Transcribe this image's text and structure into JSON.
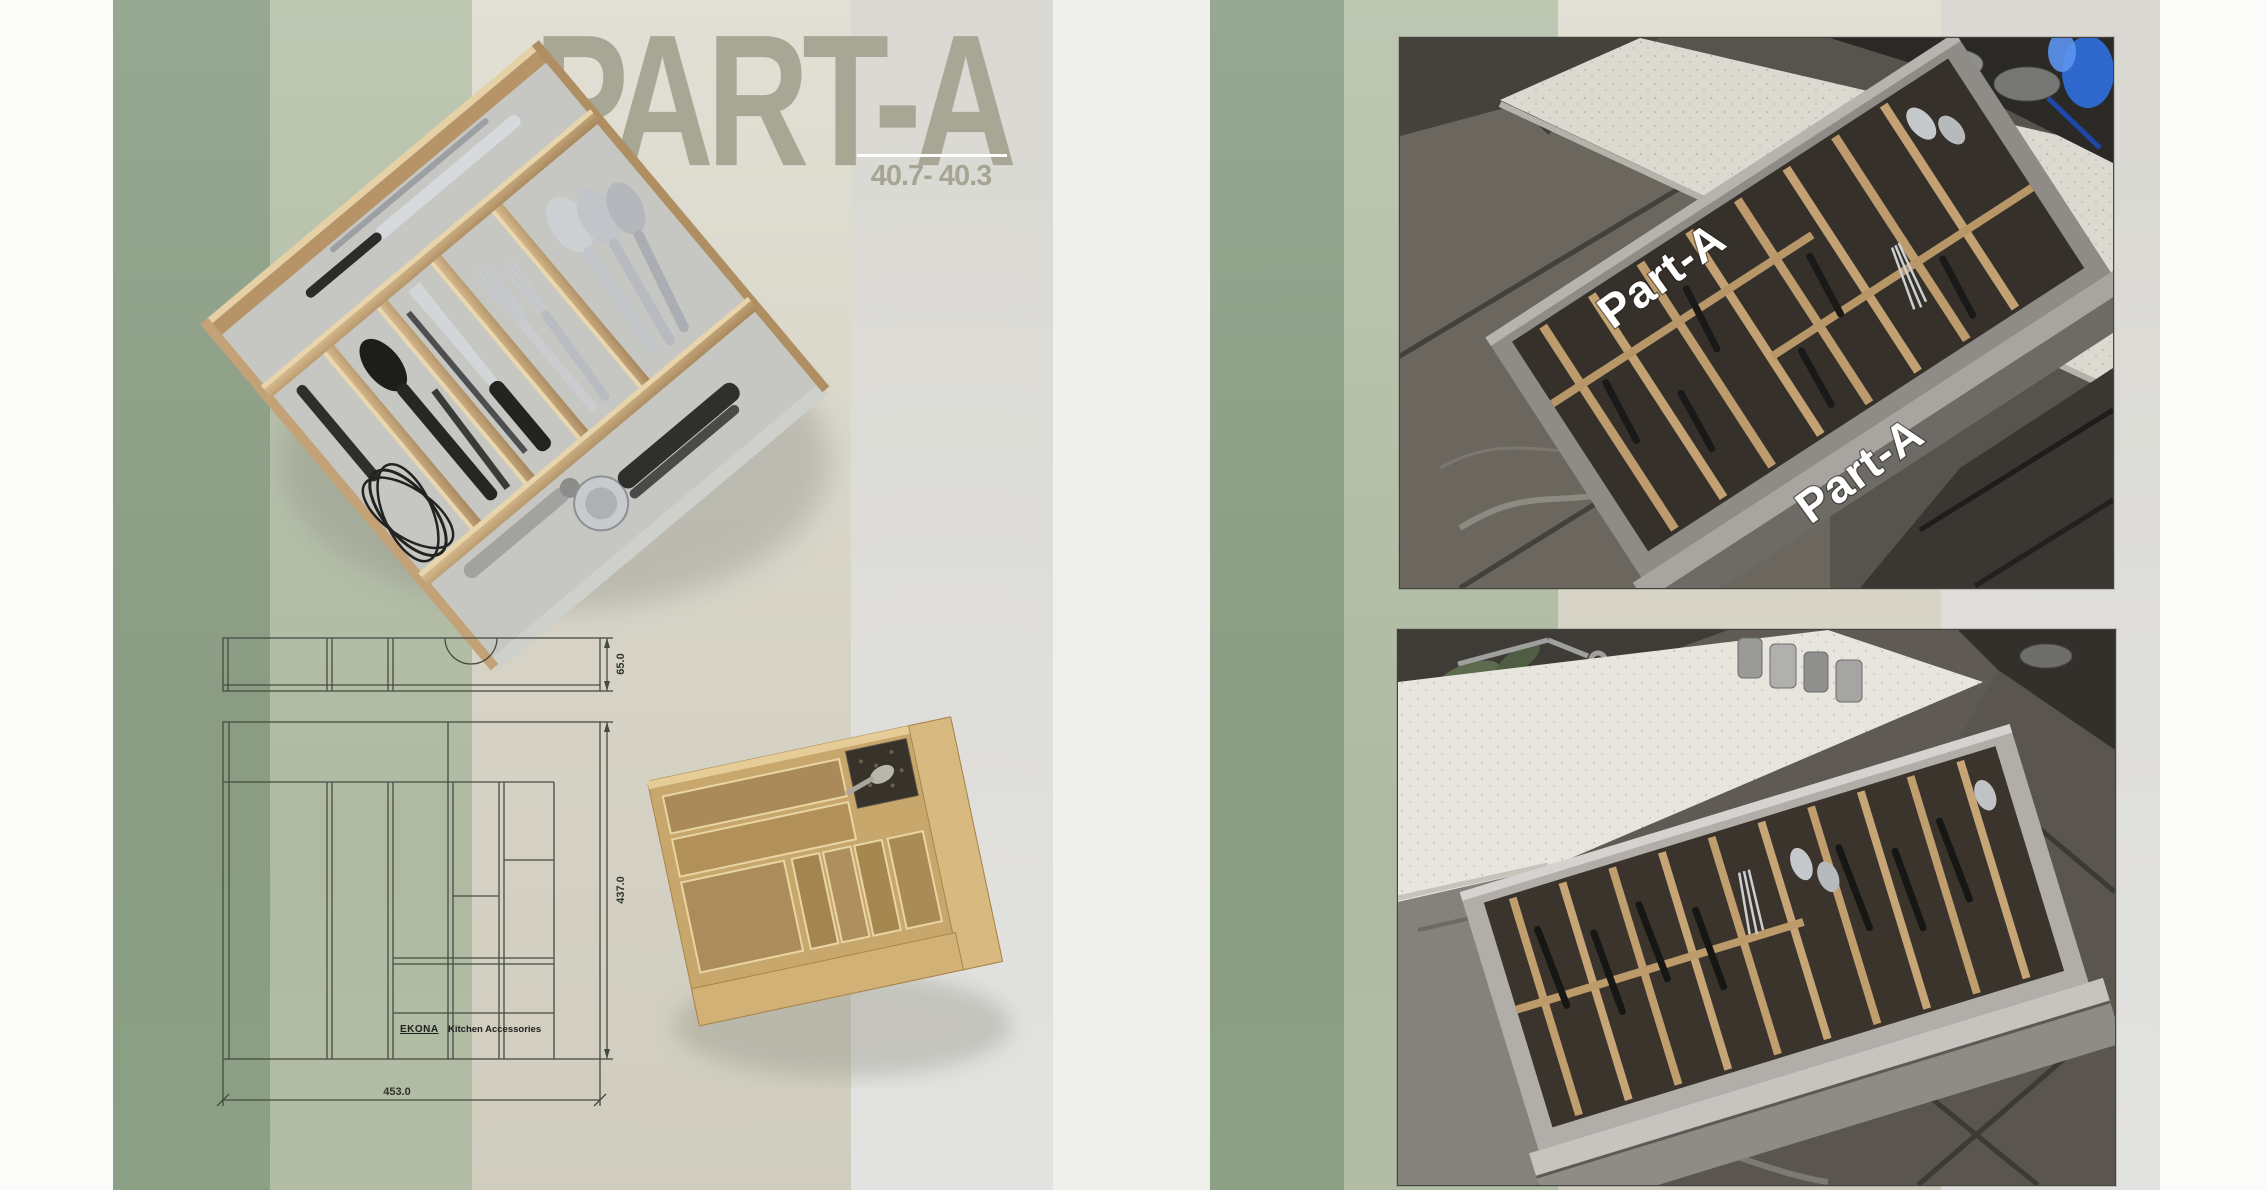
{
  "left_page": {
    "title": "PART-A",
    "subtitle": "40.7- 40.3",
    "technical_drawing": {
      "width_mm": "453.0",
      "depth_mm": "437.0",
      "height_mm": "65.0",
      "logo_brand": "EKONA",
      "logo_text": "Kitchen Accessories"
    }
  },
  "right_page": {
    "photo_top_watermarks": [
      "Part-A",
      "Part-A"
    ]
  },
  "palette": {
    "sage": "#8da089",
    "sage_light": "#b6c1ab",
    "cream": "#dcd9cc",
    "warm_gray": "#e2e2e0",
    "page_white": "#fbfbfa",
    "title_text": "#a6a492",
    "wood": "#c2a176",
    "gold_tray": "#c8a76c",
    "drawer_gray": "#8f8c87",
    "flame_blue": "#2f6fe0"
  }
}
